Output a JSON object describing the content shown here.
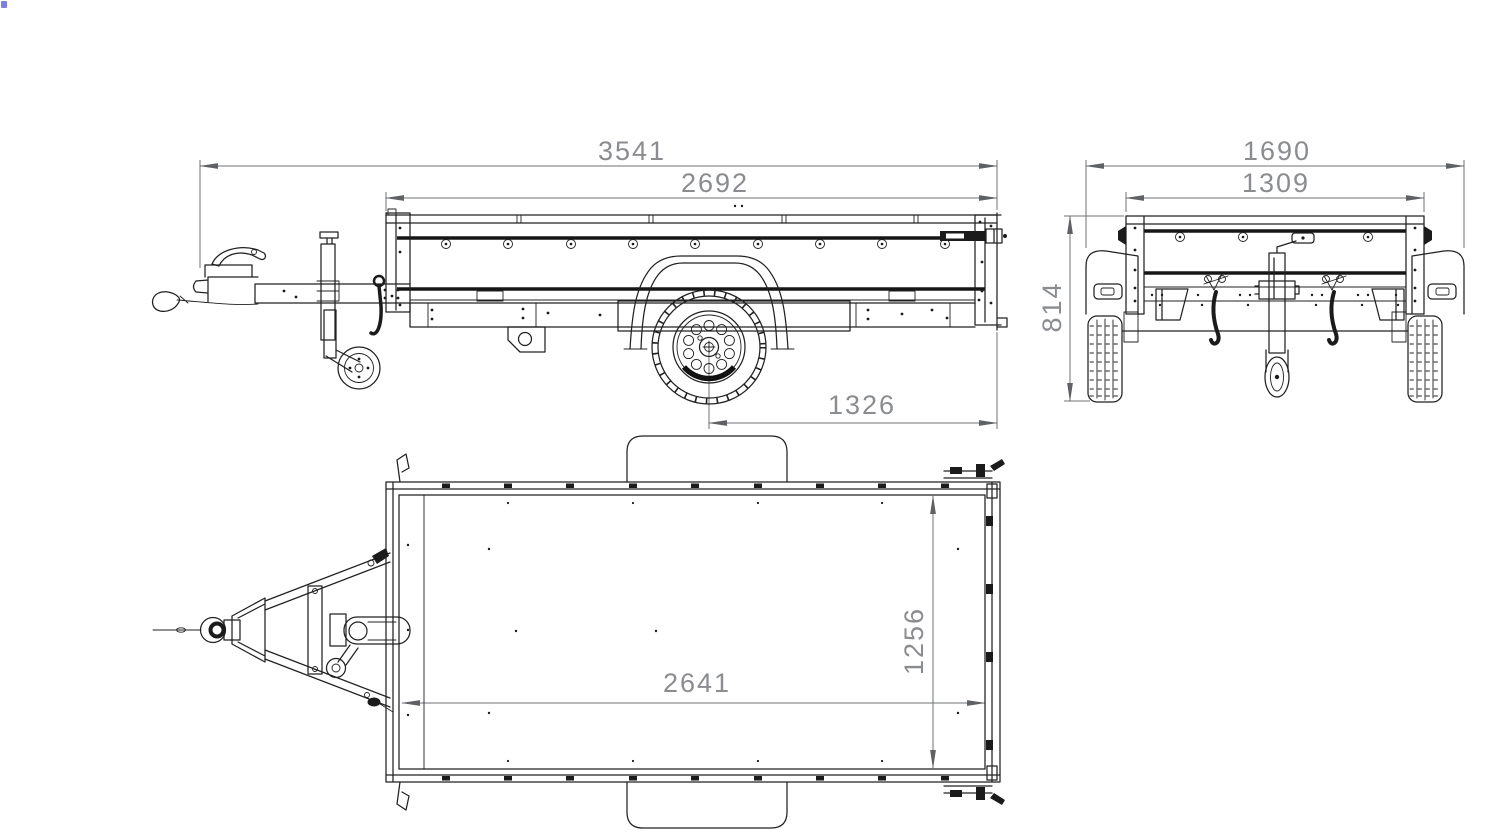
{
  "artifact": {
    "color": "#7d7fe9"
  },
  "colors": {
    "background": "#ffffff",
    "line": "#212121",
    "dark_fill": "#1b1b1b",
    "dimension_line": "#6f7175",
    "dimension_text": "#8a8c90"
  },
  "views": {
    "side": {
      "dims": {
        "overall_length": "3541",
        "box_length": "2692",
        "axle_to_rear": "1326"
      }
    },
    "rear": {
      "dims": {
        "overall_width": "1690",
        "box_width": "1309",
        "height": "814"
      }
    },
    "top": {
      "dims": {
        "bed_length": "2641",
        "bed_width": "1256"
      }
    }
  }
}
